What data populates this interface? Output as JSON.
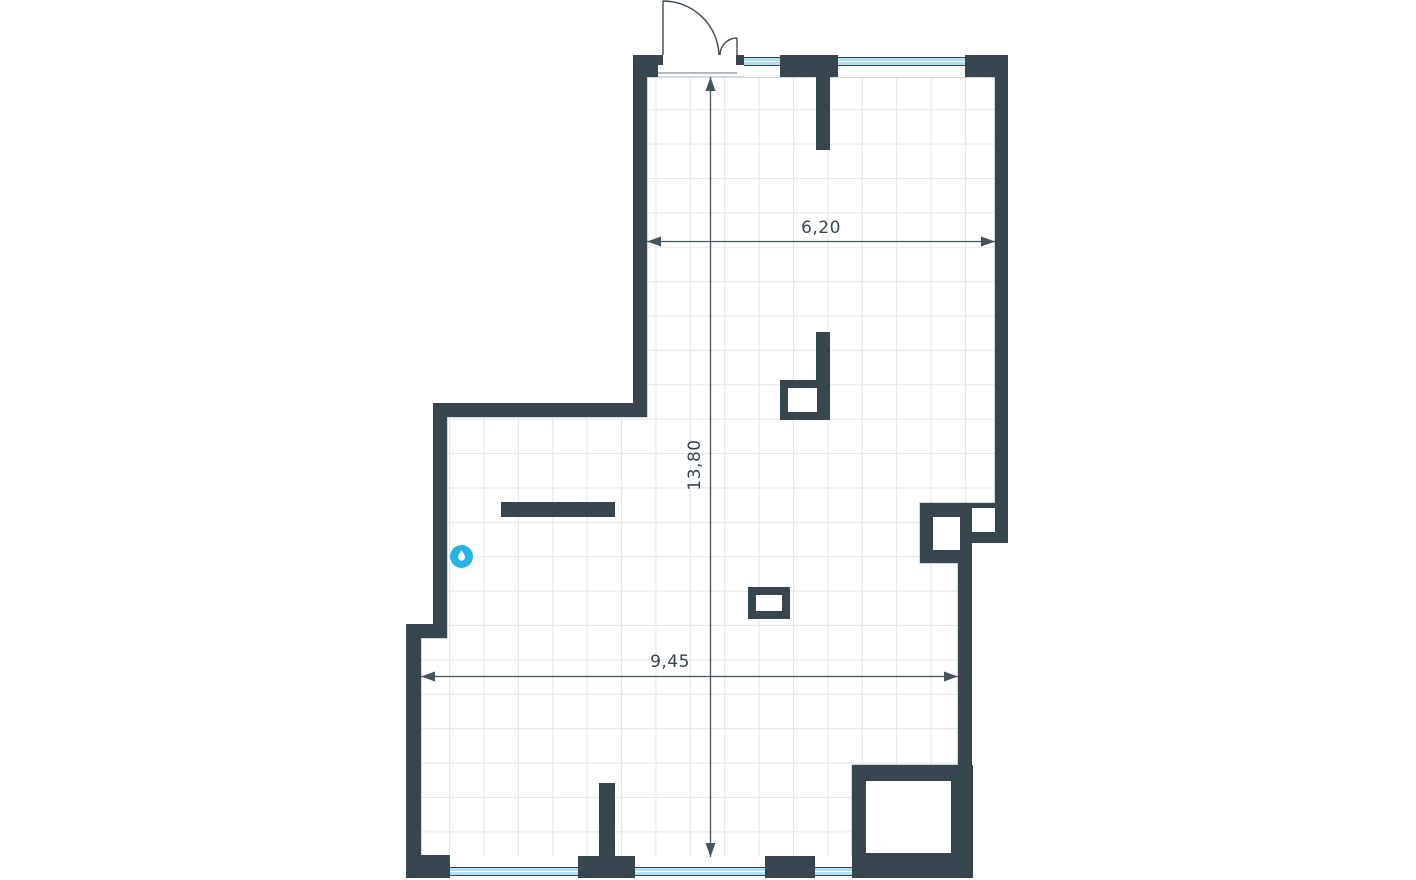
{
  "plan": {
    "type": "apartment-floor-plan",
    "dimension_labels": {
      "top_width": "6,20",
      "height": "13,80",
      "bottom_width": "9,45"
    },
    "features": {
      "entrance_door": "double-swing-door-top",
      "windows_top": 2,
      "windows_bottom": 3,
      "water_point": "water-drop-marker"
    }
  },
  "icons": {
    "water_drop": "droplet"
  },
  "colors": {
    "wall": "#36454E",
    "glass": "#AEE0F2",
    "accent": "#29B2E8",
    "grid": "#E5E5E5",
    "dim_line": "#44535C",
    "text": "#36454E",
    "floor_outline": "#C6CBCE"
  }
}
